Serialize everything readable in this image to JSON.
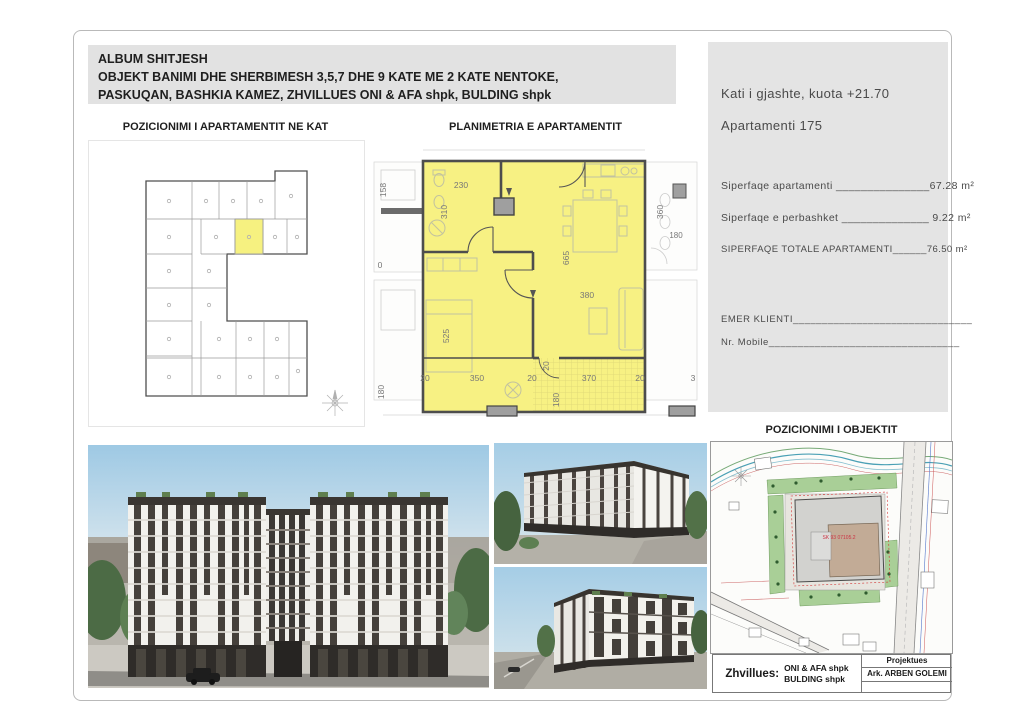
{
  "header": {
    "line1": "ALBUM SHITJESH",
    "line2": "OBJEKT BANIMI DHE SHERBIMESH 3,5,7 DHE 9 KATE ME 2 KATE NENTOKE,",
    "line3": "PASKUQAN, BASHKIA KAMEZ, ZHVILLUES ONI & AFA shpk, BULDING shpk"
  },
  "titles": {
    "floor_position": "POZICIONIMI I APARTAMENTIT NE KAT",
    "apartment_plan": "PLANIMETRIA E APARTAMENTIT",
    "object_position": "POZICIONIMI I OBJEKTIT"
  },
  "info_panel": {
    "floor": "Kati i gjashte, kuota +21.70",
    "apartment": "Apartamenti 175",
    "area1_label": "Siperfaqe apartamenti ",
    "area1_line": "_______________",
    "area1_value": "67.28 m²",
    "area2_label": "Siperfaqe e perbashket ",
    "area2_line": "______________",
    "area2_value": " 9.22 m²",
    "area3_label": "SIPERFAQE TOTALE APARTAMENTI",
    "area3_line": "______",
    "area3_value": "76.50 m²",
    "client_label": "EMER KLIENTI",
    "client_line": "_______________________________",
    "mobile_label": "Nr. Mobile",
    "mobile_line": "_________________________________"
  },
  "plan_dims": {
    "d230": "230",
    "d310": "310",
    "d665": "665",
    "d380": "380",
    "d525": "525",
    "d350": "350",
    "d370": "370",
    "d20a": "20",
    "d20b": "20",
    "d20c": "20",
    "d20v": "20",
    "d180balc": "180",
    "d360": "360",
    "d180n": "180",
    "d158": "158",
    "d0": "0",
    "d180l": "180",
    "d3": "3"
  },
  "site_map": {
    "cadastral": "SK 93 07105.2"
  },
  "title_block": {
    "developer_label": "Zhvillues:",
    "developer_line1": "ONI & AFA shpk",
    "developer_line2": "BULDING shpk",
    "designer_title": "Projektues",
    "designer_name": "Ark. ARBEN GOLEMI"
  },
  "colors": {
    "highlight": "#f6f180",
    "panel": "#e4e4e4",
    "header_box": "#e2e2e2"
  }
}
